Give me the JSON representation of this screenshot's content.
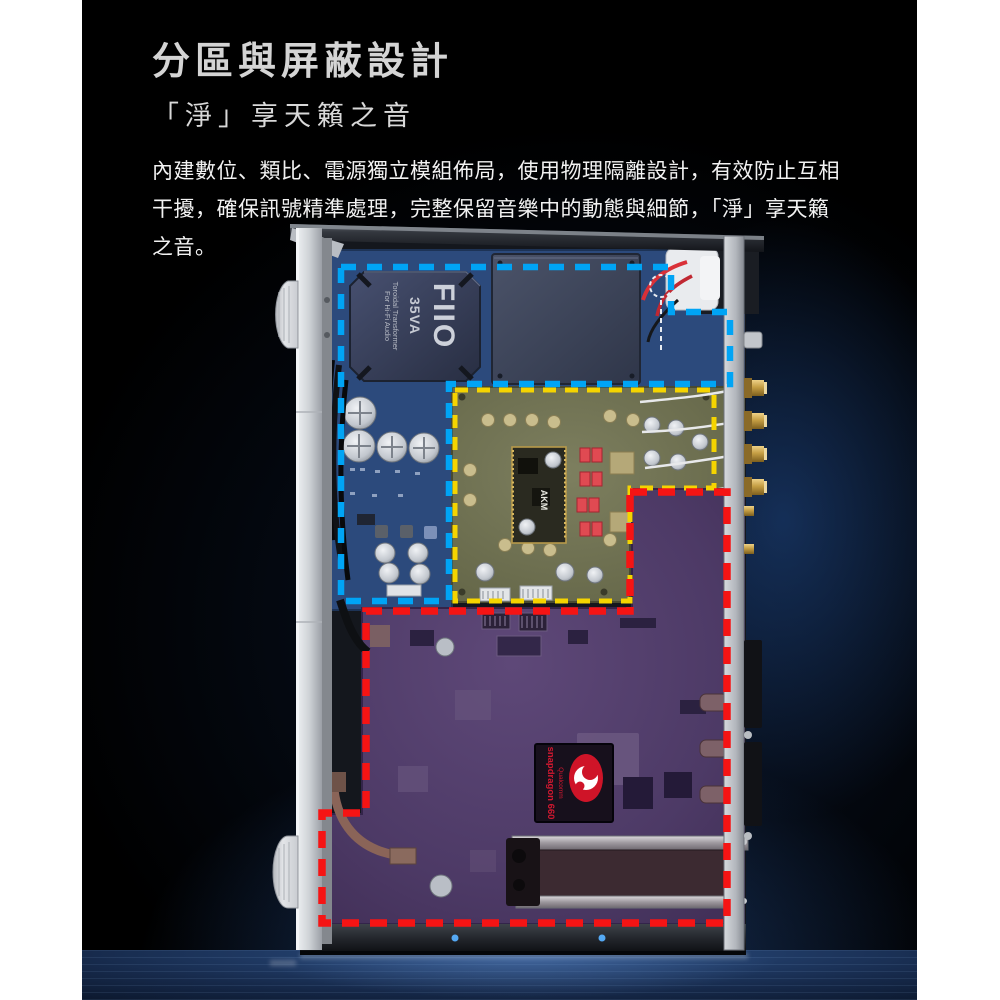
{
  "header": {
    "title": "分區與屏蔽設計",
    "subtitle": "「淨」享天籟之音"
  },
  "intro": {
    "lines": [
      "內建數位、類比、電源獨立模組佈局，使用物理隔離設計，有效防止互相",
      "干擾，確保訊號精準處理，完整保留音樂中的動態與細節，「淨」享天籟",
      "之音。"
    ]
  },
  "device": {
    "transformer": {
      "brand": "FIIO",
      "rating": "35VA",
      "desc_line1": "Toroidal Transformer",
      "desc_line2": "For Hi-Fi Audio"
    },
    "dac_module": {
      "label": "AKM"
    },
    "soc": {
      "brand": "Qualcomm",
      "model": "snapdragon 660"
    },
    "zones": {
      "power": {
        "name": "power-supply-zone",
        "color": "#00a4f5"
      },
      "audio": {
        "name": "analog-audio-zone",
        "color": "#f5d400"
      },
      "digital": {
        "name": "digital-zone",
        "color": "#f51414"
      }
    }
  }
}
